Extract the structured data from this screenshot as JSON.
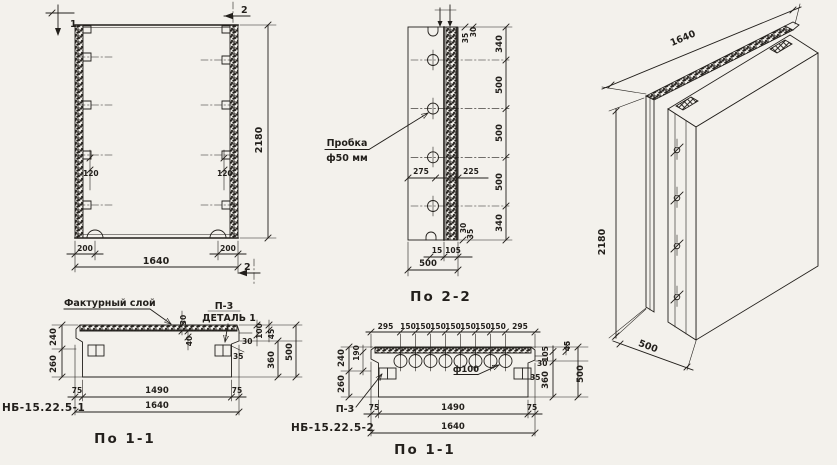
{
  "colors": {
    "ink": "#221f1b",
    "paper": "#f3f1ec",
    "facing_fill": "#d9d4cb"
  },
  "front_view": {
    "section_mark_1": "1",
    "section_mark_2_top": "2",
    "section_mark_2_bottom": "2",
    "dim_inset_left": "120",
    "dim_inset_right": "120",
    "dim_edge_left": "200",
    "dim_edge_right": "200",
    "dim_width": "1640",
    "dim_height": "2180"
  },
  "section_2_2": {
    "title": "По 2-2",
    "plug_label_line1": "Пробка",
    "plug_label_line2": "ф50 мм",
    "dim_col": [
      "340",
      "500",
      "500",
      "500",
      "340"
    ],
    "dim_275": "275",
    "dim_225": "225",
    "dim_top_35": "35",
    "dim_top_30": "30",
    "dim_bot_30": "30",
    "dim_bot_35": "35",
    "dim_15": "15",
    "dim_105": "105",
    "dim_500": "500"
  },
  "iso_view": {
    "dim_width": "1640",
    "dim_height": "2180",
    "dim_depth": "500"
  },
  "section_1_1_left": {
    "title": "По 1-1",
    "mark": "НБ-15.22.5-1",
    "facing_label": "Фактурный слой",
    "p3_label": "П-3",
    "detail_label": "ДЕТАЛЬ 1",
    "dim_30": "30",
    "dim_40": "40",
    "dim_240": "240",
    "dim_260": "260",
    "dim_r30": "30",
    "dim_r35": "35",
    "dim_100": "100",
    "dim_45": "45",
    "dim_360": "360",
    "dim_500": "500",
    "dim_75l": "75",
    "dim_1490": "1490",
    "dim_75r": "75",
    "dim_1640": "1640"
  },
  "section_1_1_mid": {
    "title": "По 1-1",
    "mark": "НБ-15.22.5-2",
    "p3_label": "П-3",
    "hole_label": "ф100",
    "dims_top": [
      "295",
      "150",
      "150",
      "150",
      "150",
      "150",
      "150",
      "150",
      "295"
    ],
    "dim_240": "240",
    "dim_190": "190",
    "dim_260": "260",
    "dim_r30": "30",
    "dim_r35": "35",
    "dim_105": "105",
    "dim_45": "45",
    "dim_360": "360",
    "dim_500": "500",
    "dim_75l": "75",
    "dim_1490": "1490",
    "dim_75r": "75",
    "dim_1640": "1640"
  }
}
